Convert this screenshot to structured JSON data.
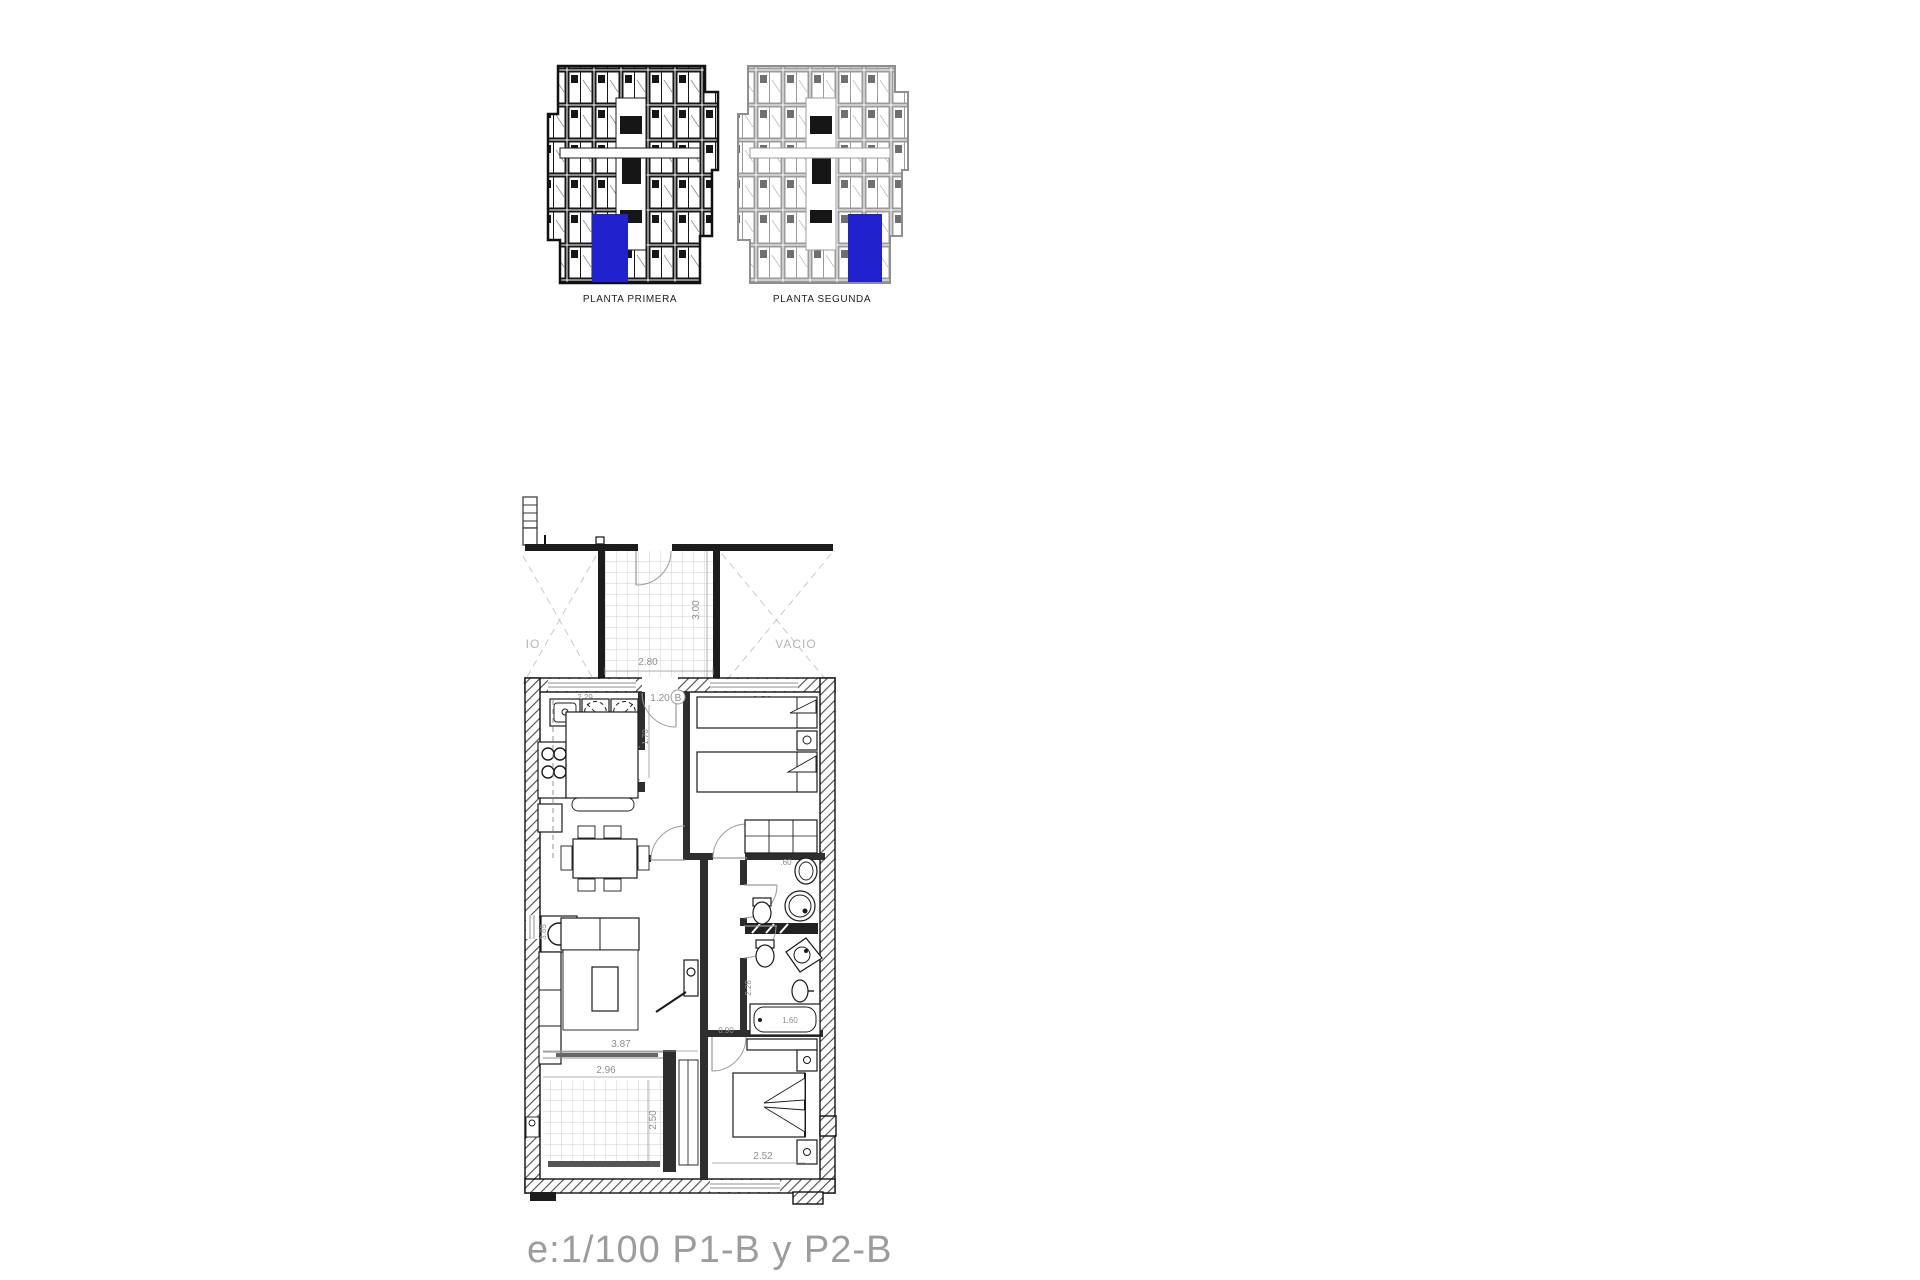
{
  "sheet": {
    "background": "#ffffff",
    "highlight_color": "#2121ce",
    "line_color": "#1a1a1a",
    "dim_color": "#8f8f8f"
  },
  "overview": {
    "primera_label": "PLANTA PRIMERA",
    "segunda_label": "PLANTA SEGUNDA"
  },
  "plan": {
    "vacio_left": "IO",
    "vacio_right": "VACIO",
    "terrace_top_width": "2.80",
    "terrace_top_depth": "3.00",
    "kitchen_width": "2.29",
    "entrance_width": "1.20",
    "entrance_door": "B",
    "hall_depth": "1.70",
    "bedroom1_width": "2.52",
    "bath1_width": ".60",
    "bath2_depth": "2.28",
    "tub_length": "1.60",
    "corridor_width": "0.90",
    "living_width": "3.87",
    "living_depth": "3.85",
    "terrace_bottom_width": "2.96",
    "terrace_bottom_depth": "2.50",
    "bedroom2_width": "2.52"
  },
  "footer": {
    "scale_label": "e:1/100  P1-B y P2-B"
  }
}
